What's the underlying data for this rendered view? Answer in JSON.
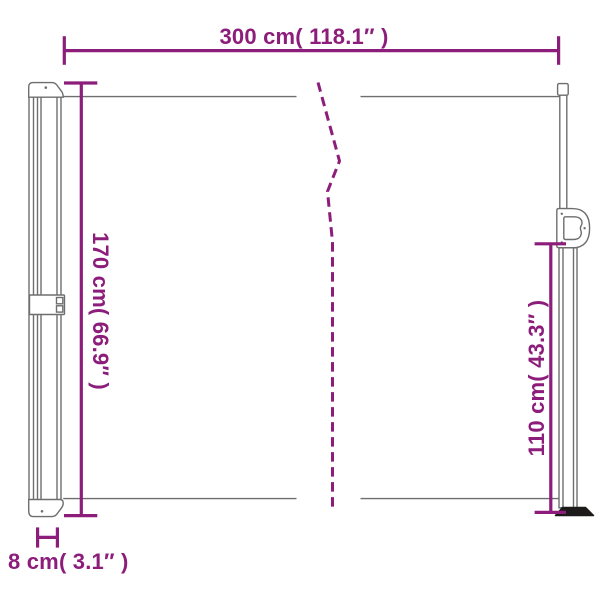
{
  "labels": {
    "width": "300 cm( 118.1″ )",
    "height_left": "170 cm( 66.9″ )",
    "height_right": "110 cm( 43.3″ )",
    "depth": "8 cm( 3.1″ )"
  },
  "values": {
    "width_cm": 300,
    "width_in": 118.1,
    "height_left_cm": 170,
    "height_left_in": 66.9,
    "height_right_cm": 110,
    "height_right_in": 43.3,
    "depth_cm": 8,
    "depth_in": 3.1
  },
  "colors": {
    "dimension": "#8c1d7a",
    "outline": "#6e6e6e",
    "base-dark": "#1d1a1a",
    "background": "#ffffff"
  }
}
